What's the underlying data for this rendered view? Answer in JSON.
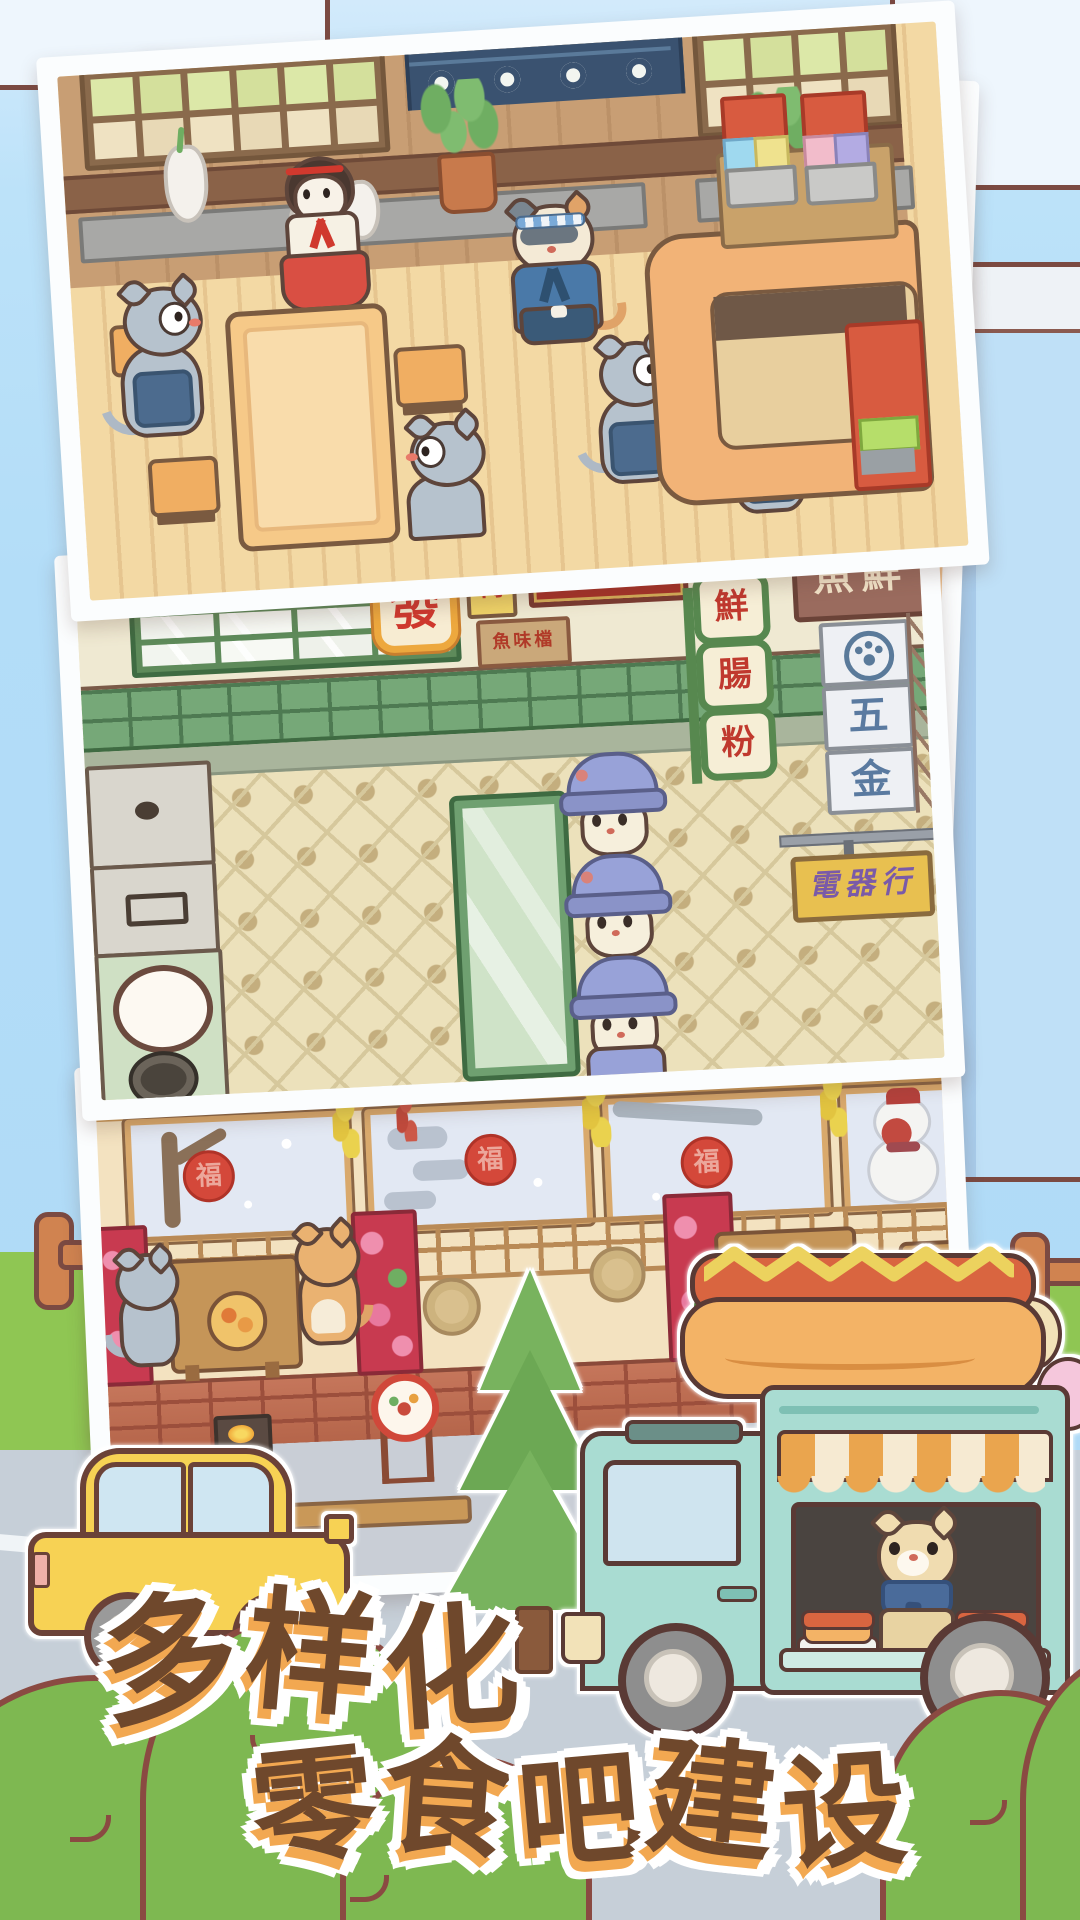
{
  "title": {
    "line1": "多样化",
    "line2": "零食吧建设",
    "chars_line1": [
      "多",
      "样",
      "化"
    ],
    "chars_line2": [
      "零",
      "食",
      "吧",
      "建",
      "设"
    ]
  },
  "photos": {
    "street": {
      "sign_fa": "發",
      "sign_small": "轉",
      "sign_banner": "財發喜慶",
      "sign_plaque": "魚味檔",
      "sign_vertical": [
        "鮮",
        "腸",
        "粉"
      ],
      "sign_fish": "魚鮮",
      "sign_hardware": [
        "五",
        "金"
      ],
      "sign_electronics": "電器行"
    },
    "winter": {
      "fu": "福"
    }
  },
  "colors": {
    "sky": "#b3ddf8",
    "title_brown": "#6f482c",
    "title_orange": "#f2a851",
    "truck_mint": "#a9dcd2",
    "car_yellow": "#f7d254",
    "grass": "#8fc653",
    "road": "#c6cfd8",
    "outline": "#7b4a42",
    "sign_red": "#d0392e"
  }
}
